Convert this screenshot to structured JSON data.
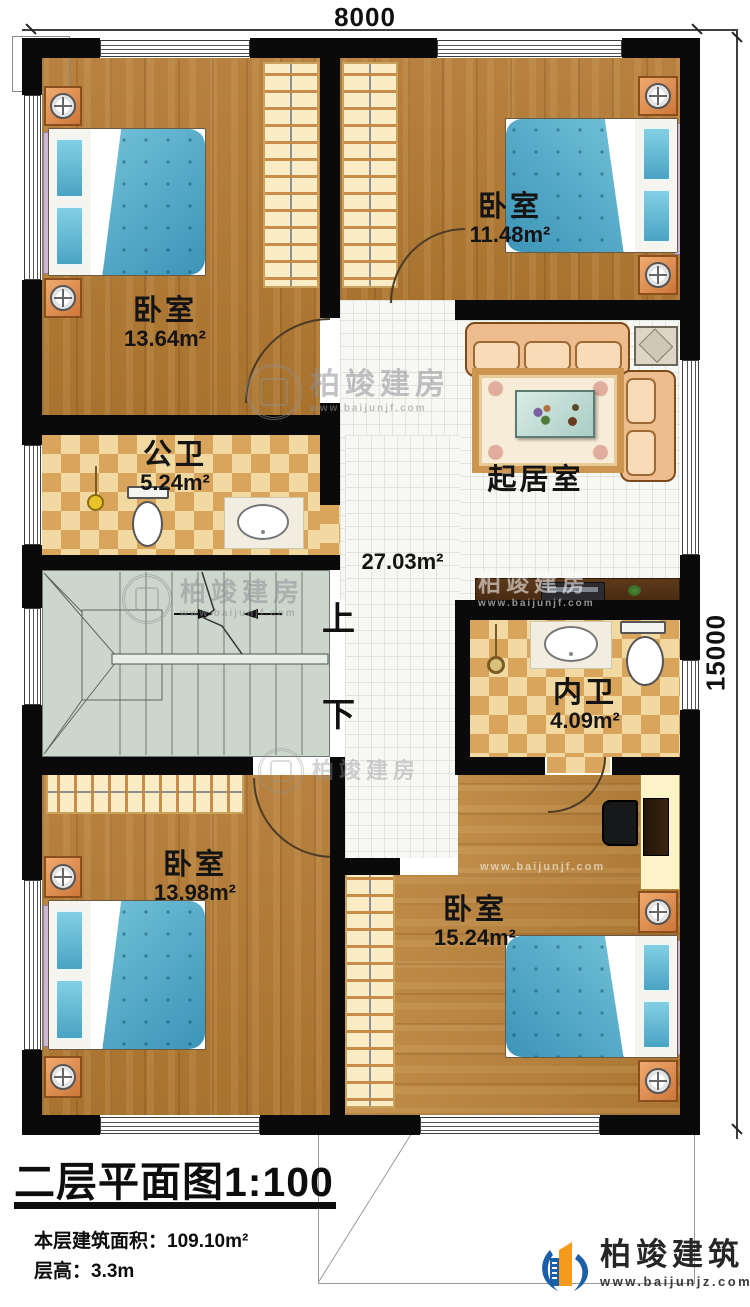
{
  "dimensions": {
    "width": "8000",
    "height": "15000"
  },
  "rooms": {
    "bedroom_tl": {
      "name": "卧室",
      "area": "13.64m²"
    },
    "bedroom_tr": {
      "name": "卧室",
      "area": "11.48m²"
    },
    "public_bath": {
      "name": "公卫",
      "area": "5.24m²"
    },
    "living": {
      "name": "起居室",
      "area": "27.03m²"
    },
    "ensuite_bath": {
      "name": "内卫",
      "area": "4.09m²"
    },
    "bedroom_bl": {
      "name": "卧室",
      "area": "13.98m²"
    },
    "bedroom_br": {
      "name": "卧室",
      "area": "15.24m²"
    }
  },
  "stairs": {
    "up_label": "上",
    "down_label": "下"
  },
  "titleblock": {
    "title": "二层平面图",
    "scale": "1:100",
    "area_line": "本层建筑面积：109.10m²",
    "height_line": "层高：3.3m"
  },
  "branding": {
    "name": "柏竣建筑",
    "website": "www.baijunjz.com"
  },
  "watermark": {
    "text": "柏竣建房",
    "website": "www.baijunjf.com"
  },
  "palette": {
    "wall": "#0a0a0a",
    "wood": "#b2793a",
    "bath_tile": "#e2b06a",
    "hall_tile": "#f6f6f4",
    "bed_blue": "#4da4c4",
    "stairs": "#cdd6cc",
    "logo_blue": "#1a5fa8",
    "logo_orange": "#f59a1d"
  }
}
